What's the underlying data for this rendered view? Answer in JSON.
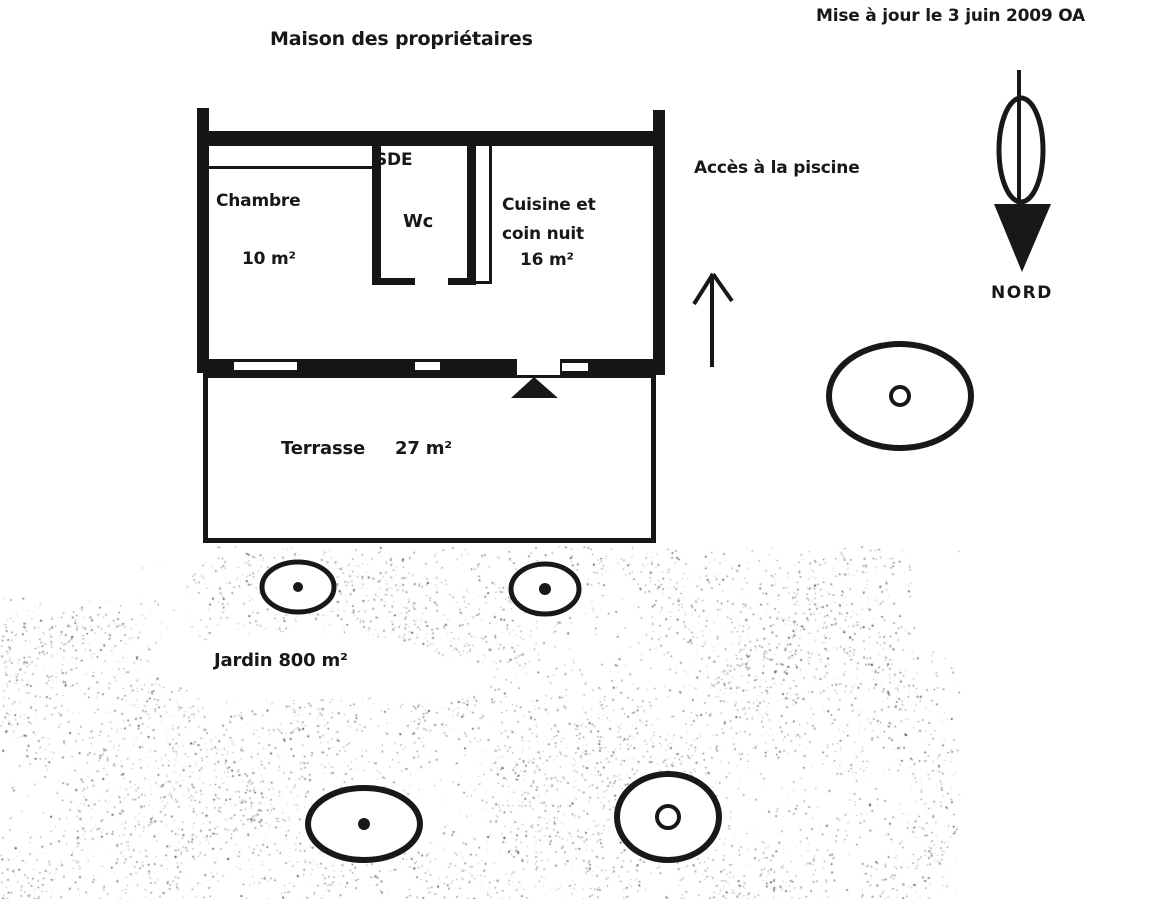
{
  "header": {
    "title": "Maison des propriétaires",
    "update_note": "Mise à jour le 3 juin 2009 OA"
  },
  "rooms": {
    "chambre": {
      "name": "Chambre",
      "area": "10 m²"
    },
    "sde": {
      "name": "SDE"
    },
    "wc": {
      "name": "Wc"
    },
    "cuisine": {
      "name_line1": "Cuisine et",
      "name_line2": "coin nuit",
      "area": "16 m²"
    },
    "terrasse": {
      "name": "Terrasse",
      "area": "27 m²"
    },
    "jardin": {
      "label": "Jardin 800 m²"
    }
  },
  "annotations": {
    "pool_access": "Accès à la piscine",
    "north_label": "NORD"
  },
  "colors": {
    "ink": "#181818",
    "paper": "#ffffff"
  },
  "plan": {
    "trees": [
      {
        "cx": 298,
        "cy": 587,
        "rx": 36,
        "ry": 25,
        "stroke": 5,
        "mark": "dot",
        "mr": 5
      },
      {
        "cx": 545,
        "cy": 589,
        "rx": 34,
        "ry": 25,
        "stroke": 5,
        "mark": "dot",
        "mr": 6
      },
      {
        "cx": 900,
        "cy": 396,
        "rx": 71,
        "ry": 52,
        "stroke": 6,
        "mark": "ring",
        "mr": 9
      },
      {
        "cx": 364,
        "cy": 824,
        "rx": 56,
        "ry": 36,
        "stroke": 6,
        "mark": "dot",
        "mr": 6
      },
      {
        "cx": 668,
        "cy": 817,
        "rx": 51,
        "ry": 43,
        "stroke": 6,
        "mark": "ring",
        "mr": 11
      }
    ],
    "compass": {
      "shaft": {
        "x": 1019,
        "y1": 70,
        "y2": 206,
        "w": 4
      },
      "ellipse": {
        "cx": 1021,
        "cy": 150,
        "rx": 22,
        "ry": 52,
        "stroke": 5
      },
      "head_points": "994,204 1051,204 1022,272"
    },
    "access_arrow": {
      "shaft": {
        "x": 712,
        "y1": 274,
        "y2": 367,
        "w": 4
      },
      "wings": [
        [
          713,
          274,
          694,
          304
        ],
        [
          713,
          274,
          732,
          301
        ]
      ]
    },
    "door_marker": {
      "points": "511,398 558,398 534,377"
    },
    "stipple": {
      "seed": 7,
      "count": 16000,
      "x_max": 960,
      "y_min": 546,
      "y_max": 899
    }
  }
}
